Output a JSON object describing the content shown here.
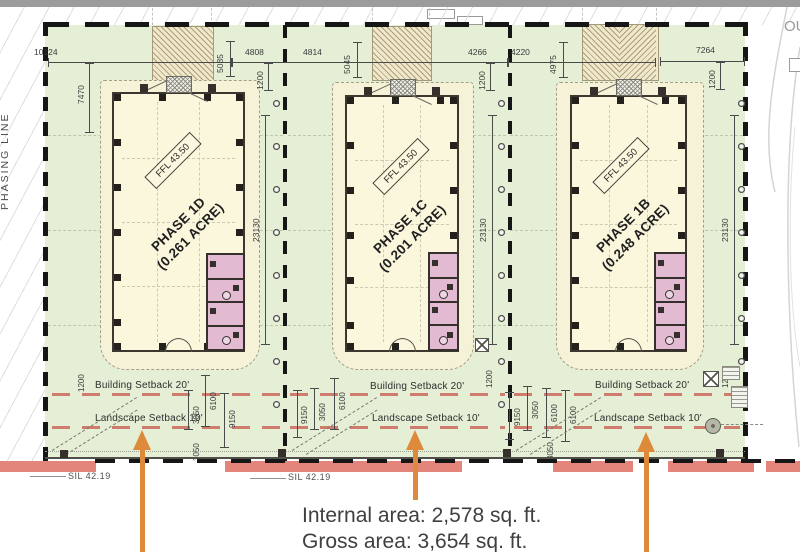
{
  "drawing": {
    "phasing_line_label": "PHASING LINE",
    "offsite_label": "OU",
    "ffl_label": "FFL 43.50",
    "notes": {
      "internal_area": "Internal area: 2,578 sq. ft.",
      "gross_area": "Gross area: 3,654 sq. ft."
    },
    "invert_levels": [
      "SIL 42.19",
      "SIL 42.19"
    ],
    "parcels": [
      {
        "phase": "PHASE 1D",
        "acre": "(0.261 ACRE)",
        "building_setback": "Building Setback 20'",
        "landscape_setback": "Landscape Setback 10'"
      },
      {
        "phase": "PHASE 1C",
        "acre": "(0.201 ACRE)",
        "building_setback": "Building Setback 20'",
        "landscape_setback": "Landscape Setback 10'"
      },
      {
        "phase": "PHASE 1B",
        "acre": "(0.248 ACRE)",
        "building_setback": "Building Setback 20'",
        "landscape_setback": "Landscape Setback 10'"
      }
    ],
    "dimensions": {
      "d10124": "10124",
      "d7470": "7470",
      "d5085": "5085",
      "d4808": "4808",
      "d4814": "4814",
      "d5045": "5045",
      "d4266": "4266",
      "d4220": "4220",
      "d4975": "4975",
      "d7264": "7264",
      "d1200": "1200",
      "d23130": "23130",
      "d3050": "3050",
      "d6100": "6100",
      "d9150": "9150"
    },
    "colors": {
      "site_green": "#e5efd6",
      "building_fill": "#fbf7dd",
      "bathroom_pink": "#e2bad2",
      "road_strip": "#e4857b",
      "setback_red": "#cf7c6f",
      "arrow_orange": "#dd8a3a"
    }
  }
}
